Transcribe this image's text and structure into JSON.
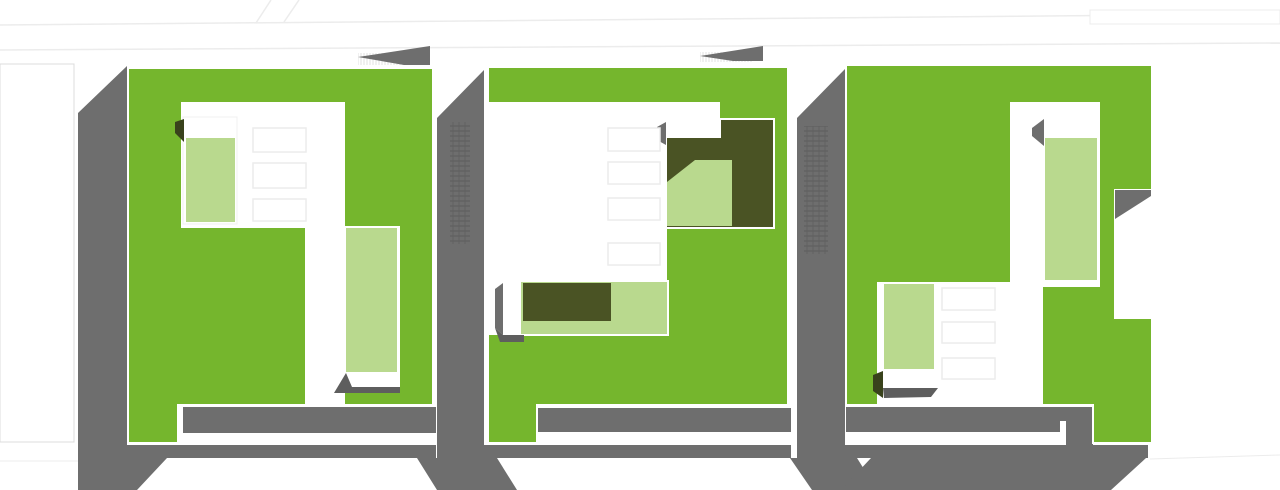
{
  "meta": {
    "title": "Axonometric site plan of three green-roof buildings",
    "canvas": {
      "width": 1280,
      "height": 490
    }
  },
  "palette": {
    "green": "#75b62d",
    "lightgreen": "#b9d98e",
    "olive": "#4a5324",
    "olivedark": "#39421c",
    "gray": "#6e6e6e",
    "shadowgray": "#5e5e5e",
    "white": "#ffffff",
    "faint": "#ececec",
    "faintborder": "#dcdcdc",
    "skylightborder": "#ececec",
    "frameborder": "#f0f0f0",
    "hatchdark": "#616161",
    "hatchlight": "#e0e0e0"
  },
  "shapes": [
    {
      "name": "street-line-upper",
      "type": "line",
      "x1": 0,
      "y1": 25,
      "x2": 1280,
      "y2": 14,
      "stroke": "faint",
      "sw": 1.5
    },
    {
      "name": "street-line-lower",
      "type": "line",
      "x1": 0,
      "y1": 50,
      "x2": 1280,
      "y2": 43,
      "stroke": "faint",
      "sw": 1.5
    },
    {
      "name": "street-branch-left",
      "type": "line",
      "x1": 256,
      "y1": 23,
      "x2": 271,
      "y2": 0,
      "stroke": "faint",
      "sw": 1.5
    },
    {
      "name": "street-branch-right",
      "type": "line",
      "x1": 284,
      "y1": 22,
      "x2": 299,
      "y2": 0,
      "stroke": "faint",
      "sw": 1.5
    },
    {
      "name": "street-block-topright",
      "type": "rect",
      "x": 1090,
      "y": 10,
      "w": 190,
      "h": 14,
      "fill": "white",
      "stroke": "faint",
      "sw": 1
    },
    {
      "name": "street-block-left",
      "type": "rect",
      "x": 0,
      "y": 64,
      "w": 74,
      "h": 378,
      "fill": "white",
      "stroke": "faintborder",
      "sw": 1
    },
    {
      "name": "street-line-bottomleft",
      "type": "line",
      "x1": 0,
      "y1": 461,
      "x2": 78,
      "y2": 461,
      "stroke": "faint",
      "sw": 1
    },
    {
      "name": "street-line-bottomright",
      "type": "line",
      "x1": 1150,
      "y1": 459,
      "x2": 1280,
      "y2": 455,
      "stroke": "faint",
      "sw": 1
    },
    {
      "name": "building1-west-wall",
      "type": "polygon",
      "points": "78,113 127,66 127,458 78,458",
      "fill": "gray"
    },
    {
      "name": "building1-west-wall-footing",
      "type": "polygon",
      "points": "78,458 167,458 137,490 78,490",
      "fill": "gray"
    },
    {
      "name": "building1-south-band",
      "type": "rect",
      "x": 127,
      "y": 445,
      "w": 309,
      "h": 13,
      "fill": "gray"
    },
    {
      "name": "building1-inner-bar",
      "type": "rect",
      "x": 183,
      "y": 407,
      "w": 253,
      "h": 26,
      "fill": "gray"
    },
    {
      "name": "wall-strip-a",
      "type": "polygon",
      "points": "437,118 484,70 484,458 437,458",
      "fill": "gray"
    },
    {
      "name": "wall-strip-a-footing",
      "type": "polygon",
      "points": "417,458 497,458 517,490 437,490",
      "fill": "gray"
    },
    {
      "name": "building2-south-band",
      "type": "rect",
      "x": 484,
      "y": 445,
      "w": 307,
      "h": 13,
      "fill": "gray"
    },
    {
      "name": "building2-inner-bar",
      "type": "rect",
      "x": 538,
      "y": 408,
      "w": 253,
      "h": 24,
      "fill": "gray"
    },
    {
      "name": "wall-strip-b",
      "type": "polygon",
      "points": "797,118 845,69 845,458 797,458",
      "fill": "gray"
    },
    {
      "name": "wall-strip-b-footing",
      "type": "polygon",
      "points": "790,458 857,458 877,490 812,490",
      "fill": "gray"
    },
    {
      "name": "building3-south-band",
      "type": "rect",
      "x": 845,
      "y": 445,
      "w": 303,
      "h": 13,
      "fill": "gray"
    },
    {
      "name": "building3-south-footing",
      "type": "polygon",
      "points": "871,458 1146,458 1111,490 841,490",
      "fill": "gray"
    },
    {
      "name": "building3-inner-bar",
      "type": "rect",
      "x": 846,
      "y": 407,
      "w": 247,
      "h": 25,
      "fill": "gray"
    },
    {
      "name": "building3-inner-bar-right",
      "type": "rect",
      "x": 1066,
      "y": 432,
      "w": 27,
      "h": 13,
      "fill": "gray"
    },
    {
      "name": "building3-bar-window",
      "type": "rect",
      "x": 1060,
      "y": 421,
      "w": 6,
      "h": 12,
      "fill": "white"
    },
    {
      "name": "building1-roof-hatch",
      "type": "rect",
      "x": 358,
      "y": 53,
      "w": 62,
      "h": 12,
      "pattern": "hatchL"
    },
    {
      "name": "building1-roof-wedge",
      "type": "polygon",
      "points": "358,57 430,46 430,65 404,65",
      "fill": "gray"
    },
    {
      "name": "building2-roof-hatch",
      "type": "rect",
      "x": 700,
      "y": 52,
      "w": 52,
      "h": 10,
      "pattern": "hatchL"
    },
    {
      "name": "building2-roof-wedge",
      "type": "polygon",
      "points": "700,56 763,46 763,61 733,61",
      "fill": "gray"
    },
    {
      "name": "building1-roof-slab",
      "type": "polygon",
      "points": "128,68 433,68 433,405 178,405 178,443 128,443",
      "fill": "green",
      "stroke": "white",
      "sw": 2
    },
    {
      "name": "building2-roof-slab",
      "type": "polygon",
      "points": "488,67 788,67 788,405 537,405 537,443 488,443",
      "fill": "green",
      "stroke": "white",
      "sw": 2
    },
    {
      "name": "building3-roof-slab",
      "type": "polygon",
      "points": "846,65 1152,65 1152,190 1115,190 1115,318 1152,318 1152,443 1093,443 1093,405 846,405",
      "fill": "green",
      "stroke": "white",
      "sw": 2
    },
    {
      "name": "building1-courtyard",
      "type": "polygon",
      "points": "181,102 345,102 345,404 305,404 305,228 181,228",
      "fill": "white"
    },
    {
      "name": "building2-courtyard",
      "type": "polygon",
      "points": "488,102 720,102 720,120 667,120 667,335 488,335",
      "fill": "white"
    },
    {
      "name": "building3-courtyard",
      "type": "polygon",
      "points": "877,282 1010,282 1010,102 1100,102 1100,287 1043,287 1043,405 877,405",
      "fill": "white"
    },
    {
      "name": "building1-pavilion-frame",
      "type": "rect",
      "x": 183,
      "y": 117,
      "w": 54,
      "h": 107,
      "fill": "white",
      "stroke": "frameborder",
      "sw": 1
    },
    {
      "name": "building1-pavilion-lawn",
      "type": "rect",
      "x": 186,
      "y": 138,
      "w": 49,
      "h": 84,
      "fill": "lightgreen"
    },
    {
      "name": "building1-pavilion-shadow",
      "type": "polygon",
      "points": "175,122 184,119 184,142 175,133",
      "fill": "olivedark"
    },
    {
      "name": "building1-skylight-1",
      "type": "rect",
      "x": 253,
      "y": 128,
      "w": 53,
      "h": 24,
      "fill": "white",
      "stroke": "skylightborder",
      "sw": 1.5
    },
    {
      "name": "building1-skylight-2",
      "type": "rect",
      "x": 253,
      "y": 163,
      "w": 53,
      "h": 25,
      "fill": "white",
      "stroke": "skylightborder",
      "sw": 1.5
    },
    {
      "name": "building1-skylight-3",
      "type": "rect",
      "x": 253,
      "y": 199,
      "w": 53,
      "h": 22,
      "fill": "white",
      "stroke": "skylightborder",
      "sw": 1.5
    },
    {
      "name": "building1-terrace-frame",
      "type": "rect",
      "x": 342,
      "y": 226,
      "w": 58,
      "h": 164,
      "fill": "white"
    },
    {
      "name": "building1-terrace-lawn",
      "type": "rect",
      "x": 346,
      "y": 228,
      "w": 51,
      "h": 144,
      "fill": "lightgreen"
    },
    {
      "name": "building1-terrace-shadow",
      "type": "polygon",
      "points": "346,373 334,393 400,393 400,387 352,387",
      "fill": "shadowgray"
    },
    {
      "name": "building2-patio-frame",
      "type": "rect",
      "x": 665,
      "y": 118,
      "w": 110,
      "h": 111,
      "fill": "white"
    },
    {
      "name": "building2-patio-deck",
      "type": "polygon",
      "points": "721,120 773,120 773,227 667,227 667,138 721,138",
      "fill": "olive"
    },
    {
      "name": "building2-patio-lawn",
      "type": "polygon",
      "points": "695,160 732,160 732,226 667,226 667,182",
      "fill": "lightgreen"
    },
    {
      "name": "building2-patio-shadow",
      "type": "polygon",
      "points": "657,127 666,122 666,145 657,140",
      "fill": "gray"
    },
    {
      "name": "building2-skylight-1",
      "type": "rect",
      "x": 608,
      "y": 128,
      "w": 52,
      "h": 23,
      "fill": "white",
      "stroke": "skylightborder",
      "sw": 1.5
    },
    {
      "name": "building2-skylight-2",
      "type": "rect",
      "x": 608,
      "y": 162,
      "w": 52,
      "h": 22,
      "fill": "white",
      "stroke": "skylightborder",
      "sw": 1.5
    },
    {
      "name": "building2-skylight-3",
      "type": "rect",
      "x": 608,
      "y": 198,
      "w": 52,
      "h": 22,
      "fill": "white",
      "stroke": "skylightborder",
      "sw": 1.5
    },
    {
      "name": "building2-skylight-4",
      "type": "rect",
      "x": 608,
      "y": 243,
      "w": 52,
      "h": 22,
      "fill": "white",
      "stroke": "skylightborder",
      "sw": 1.5
    },
    {
      "name": "building2-bar-lawn",
      "type": "rect",
      "x": 520,
      "y": 281,
      "w": 148,
      "h": 54,
      "fill": "lightgreen",
      "stroke": "white",
      "sw": 2
    },
    {
      "name": "building2-bar-deck",
      "type": "rect",
      "x": 523,
      "y": 283,
      "w": 88,
      "h": 38,
      "fill": "olive"
    },
    {
      "name": "building2-bar-cap",
      "type": "rect",
      "x": 503,
      "y": 281,
      "w": 18,
      "h": 54,
      "fill": "white"
    },
    {
      "name": "building2-bar-side-shadow",
      "type": "polygon",
      "points": "495,289 503,283 503,335 495,328",
      "fill": "gray"
    },
    {
      "name": "building2-bar-bottom-shadow",
      "type": "polygon",
      "points": "495,328 503,335 524,335 524,342 500,342",
      "fill": "shadowgray"
    },
    {
      "name": "building3-notch-wedge",
      "type": "polygon",
      "points": "1115,190 1151,190 1151,196 1115,219",
      "fill": "gray"
    },
    {
      "name": "building3-terrace-lawn",
      "type": "rect",
      "x": 1045,
      "y": 138,
      "w": 52,
      "h": 142,
      "fill": "lightgreen"
    },
    {
      "name": "building3-terrace-shadow",
      "type": "polygon",
      "points": "1032,128 1044,119 1044,146 1032,136",
      "fill": "gray"
    },
    {
      "name": "building3-pavilion-band",
      "type": "rect",
      "x": 883,
      "y": 370,
      "w": 54,
      "h": 20,
      "fill": "white"
    },
    {
      "name": "building3-pavilion-lawn",
      "type": "rect",
      "x": 883,
      "y": 283,
      "w": 52,
      "h": 87,
      "fill": "lightgreen",
      "stroke": "white",
      "sw": 2
    },
    {
      "name": "building3-pavilion-shadow",
      "type": "polygon",
      "points": "873,375 883,371 883,398 873,391",
      "fill": "olivedark"
    },
    {
      "name": "building3-pavilion-base-shadow",
      "type": "polygon",
      "points": "883,388 938,388 931,397 884,398",
      "fill": "shadowgray"
    },
    {
      "name": "building3-skylight-1",
      "type": "rect",
      "x": 942,
      "y": 288,
      "w": 53,
      "h": 22,
      "fill": "white",
      "stroke": "skylightborder",
      "sw": 1.5
    },
    {
      "name": "building3-skylight-2",
      "type": "rect",
      "x": 942,
      "y": 322,
      "w": 53,
      "h": 21,
      "fill": "white",
      "stroke": "skylightborder",
      "sw": 1.5
    },
    {
      "name": "building3-skylight-3",
      "type": "rect",
      "x": 942,
      "y": 358,
      "w": 53,
      "h": 21,
      "fill": "white",
      "stroke": "skylightborder",
      "sw": 1.5
    },
    {
      "name": "wall-strip-a-windows",
      "type": "rect",
      "x": 450,
      "y": 122,
      "w": 20,
      "h": 122,
      "pattern": "hatchD"
    },
    {
      "name": "wall-strip-b-windows",
      "type": "rect",
      "x": 804,
      "y": 126,
      "w": 24,
      "h": 128,
      "pattern": "hatchD"
    }
  ]
}
